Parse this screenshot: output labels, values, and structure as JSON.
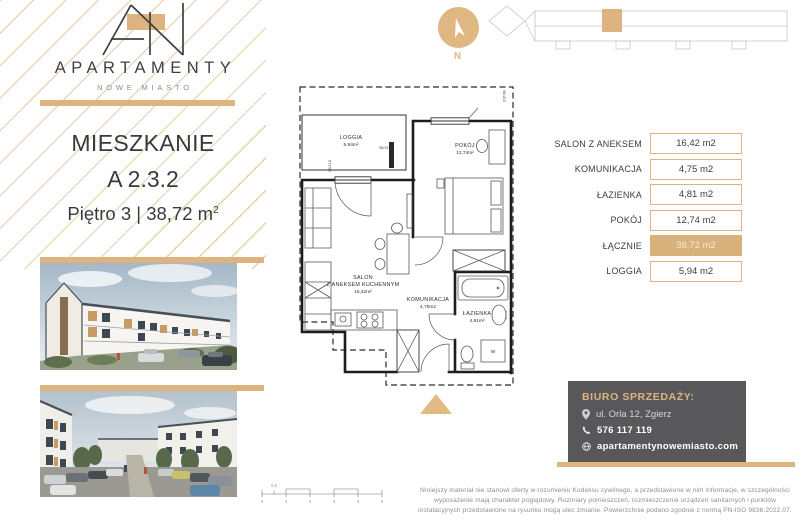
{
  "brand": {
    "name": "APARTAMENTY",
    "tagline": "NOWE MIASTO"
  },
  "listing": {
    "title": "MIESZKANIE",
    "unit_number": "A 2.3.2",
    "floor_and_area": "Piętro 3 | 38,72 m",
    "area_superscript": "2"
  },
  "compass": {
    "north_label": "N"
  },
  "floor_plan": {
    "rooms": [
      {
        "name": "LOGGIA",
        "area": "5,94m²"
      },
      {
        "name": "POKÓJ",
        "area": "12,74m²"
      },
      {
        "name": "SALON",
        "name_line2": "Z ANEKSEM KUCHENNYM",
        "area": "16,42m²"
      },
      {
        "name": "KOMUNIKACJA",
        "area": "4,75m2"
      },
      {
        "name": "ŁAZIENKA",
        "area": "4,81m²"
      }
    ],
    "dimension_labels": [
      "90/210",
      "90/210",
      "90/210"
    ],
    "washer_label": "W"
  },
  "area_table": {
    "rows": [
      {
        "label": "SALON Z ANEKSEM",
        "value": "16,42 m2",
        "highlight": false
      },
      {
        "label": "KOMUNIKACJA",
        "value": "4,75 m2",
        "highlight": false
      },
      {
        "label": "ŁAZIENKA",
        "value": "4,81 m2",
        "highlight": false
      },
      {
        "label": "POKÓJ",
        "value": "12,74 m2",
        "highlight": false
      },
      {
        "label": "ŁĄCZNIE",
        "value": "38,72 m2",
        "highlight": true
      },
      {
        "label": "LOGGIA",
        "value": "5,94 m2",
        "highlight": false
      }
    ]
  },
  "sales_office": {
    "heading": "BIURO SPRZEDAŻY:",
    "address": "ul. Orla 12, Zgierz",
    "phone": "576 117 119",
    "website": "apartamentynowemiasto.com"
  },
  "scale_bar": {
    "tick_labels": [
      "0",
      "1",
      "2",
      "3",
      "4",
      "5"
    ],
    "half_label": "0,5"
  },
  "disclaimer": "Niniejszy materiał nie stanowi oferty w rozumieniu Kodeksu cywilnego, a przedstawione w nim informacje, w szczególności wyposażenie mają charakter poglądowy. Rozmiary pomieszczeń, rozmieszczenie urządzeń sanitarnych i punktów instalacyjnych przedstawione na rysunku mogą ulec zmianie. Powierzchnie podano zgodnie z normą PN-ISO 9836:2022.07.",
  "colors": {
    "gold": "#DDB480",
    "dark_text": "#3C3C3B",
    "panel_gray": "#58585A",
    "muted_text": "#8F8F8F"
  }
}
